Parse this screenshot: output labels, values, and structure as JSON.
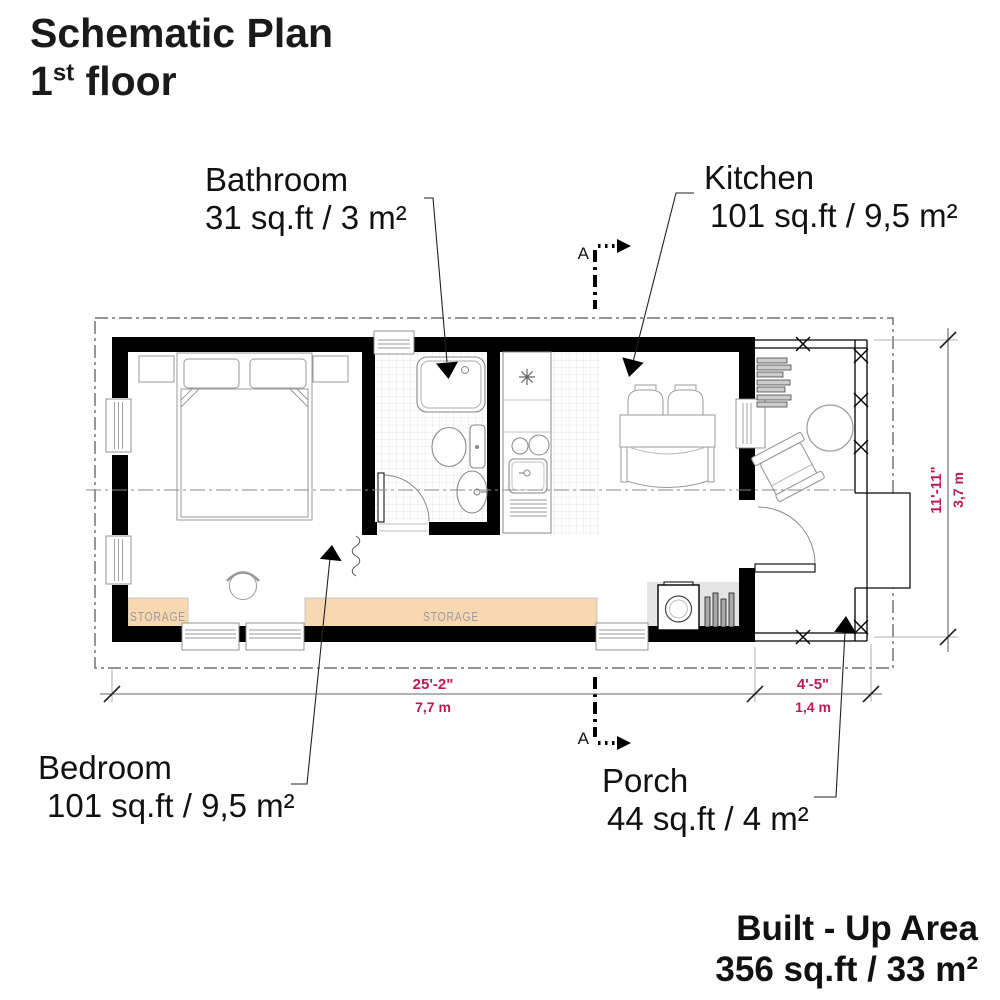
{
  "title": {
    "line1": "Schematic Plan",
    "floor_number": "1",
    "floor_ordinal": "st",
    "floor_word": " floor"
  },
  "rooms": {
    "bathroom": {
      "name": "Bathroom",
      "area": "31 sq.ft / 3 m²"
    },
    "kitchen": {
      "name": "Kitchen",
      "area": "101 sq.ft / 9,5 m²"
    },
    "bedroom": {
      "name": "Bedroom",
      "area": "101 sq.ft / 9,5 m²"
    },
    "porch": {
      "name": "Porch",
      "area": "44 sq.ft / 4 m²"
    }
  },
  "dimensions": {
    "house_width": {
      "imperial": "25'-2\"",
      "metric": "7,7 m"
    },
    "porch_width": {
      "imperial": "4'-5\"",
      "metric": "1,4 m"
    },
    "house_depth": {
      "imperial": "11'-11\"",
      "metric": "3,7 m"
    }
  },
  "section_marker": {
    "label": "A"
  },
  "storage": {
    "label": "STORAGE"
  },
  "built_up_area": {
    "title": "Built - Up Area",
    "value": "356 sq.ft / 33 m²"
  },
  "colors": {
    "wall": "#000000",
    "dimension_text": "#c01952",
    "dimension_line": "#666666",
    "storage_fill": "#f8d8b0",
    "storage_text": "#9b9b9b",
    "furniture_line": "#999999",
    "fixture_line": "#888888",
    "mat_fill": "#e5e5e5",
    "tile_line": "#dddddd",
    "boundary_line": "#555555"
  }
}
